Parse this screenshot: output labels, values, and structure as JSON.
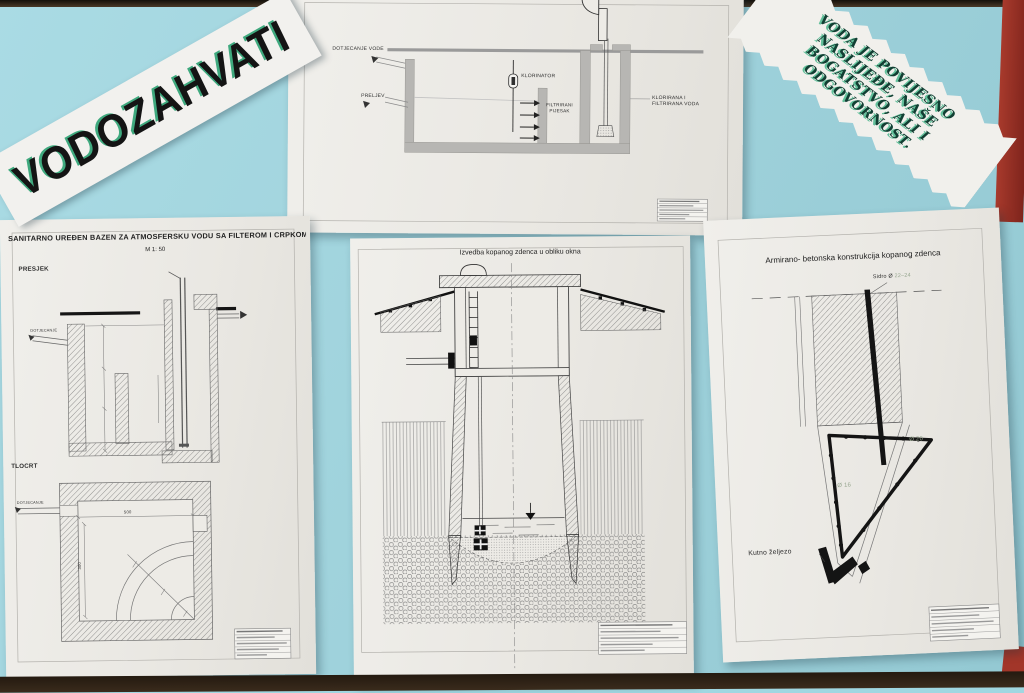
{
  "colors": {
    "board": "#a0d7e1",
    "frame": "#3a2b1c",
    "ribbon_red": "#a23629",
    "banner_shadow_green": "#3fa97e",
    "quote_green": "#123f33",
    "dimension_green": "#97a68f",
    "paper": "#eae8e3"
  },
  "banner": {
    "text": "VODOZAHVATI"
  },
  "quote": {
    "lines": [
      "VODA JE POVIJESNO",
      "NASLIJEĐE, NAŠE",
      "BOGATSTVO, ALI I",
      "ODGOVORNOST."
    ]
  },
  "top_drawing": {
    "labels": {
      "inflow": "DOTJECANJE VODE",
      "overflow": "PRELJEV",
      "chlorinator": "KLORINATOR",
      "filter_sand": "FILTRIRANI PIJESAK",
      "outflow": "KLORIRANA I FILTRIRANA VODA"
    }
  },
  "bottom_left": {
    "title": "SANITARNO UREĐEN BAZEN ZA ATMOSFERSKU VODU SA FILTEROM I CRPKOM",
    "scale": "M 1: 50",
    "section_label": "PRESJEK",
    "plan_label": "TLOCRT",
    "inflow_label": "DOTJECANJE",
    "plan_inflow_label": "DOTJECANJE",
    "dim_width": "500",
    "dim_depth": "300"
  },
  "bottom_center": {
    "title": "Izvedba kopanog zdenca u obliku okna"
  },
  "bottom_right": {
    "title": "Armirano- betonska konstrukcija kopanog zdenca",
    "anchor_label": "Sidro Ø",
    "anchor_size": "22–24",
    "rebar_right": "Ø 20",
    "rebar_left": "Ø 16",
    "angle_iron_label": "Kutno željezo"
  }
}
